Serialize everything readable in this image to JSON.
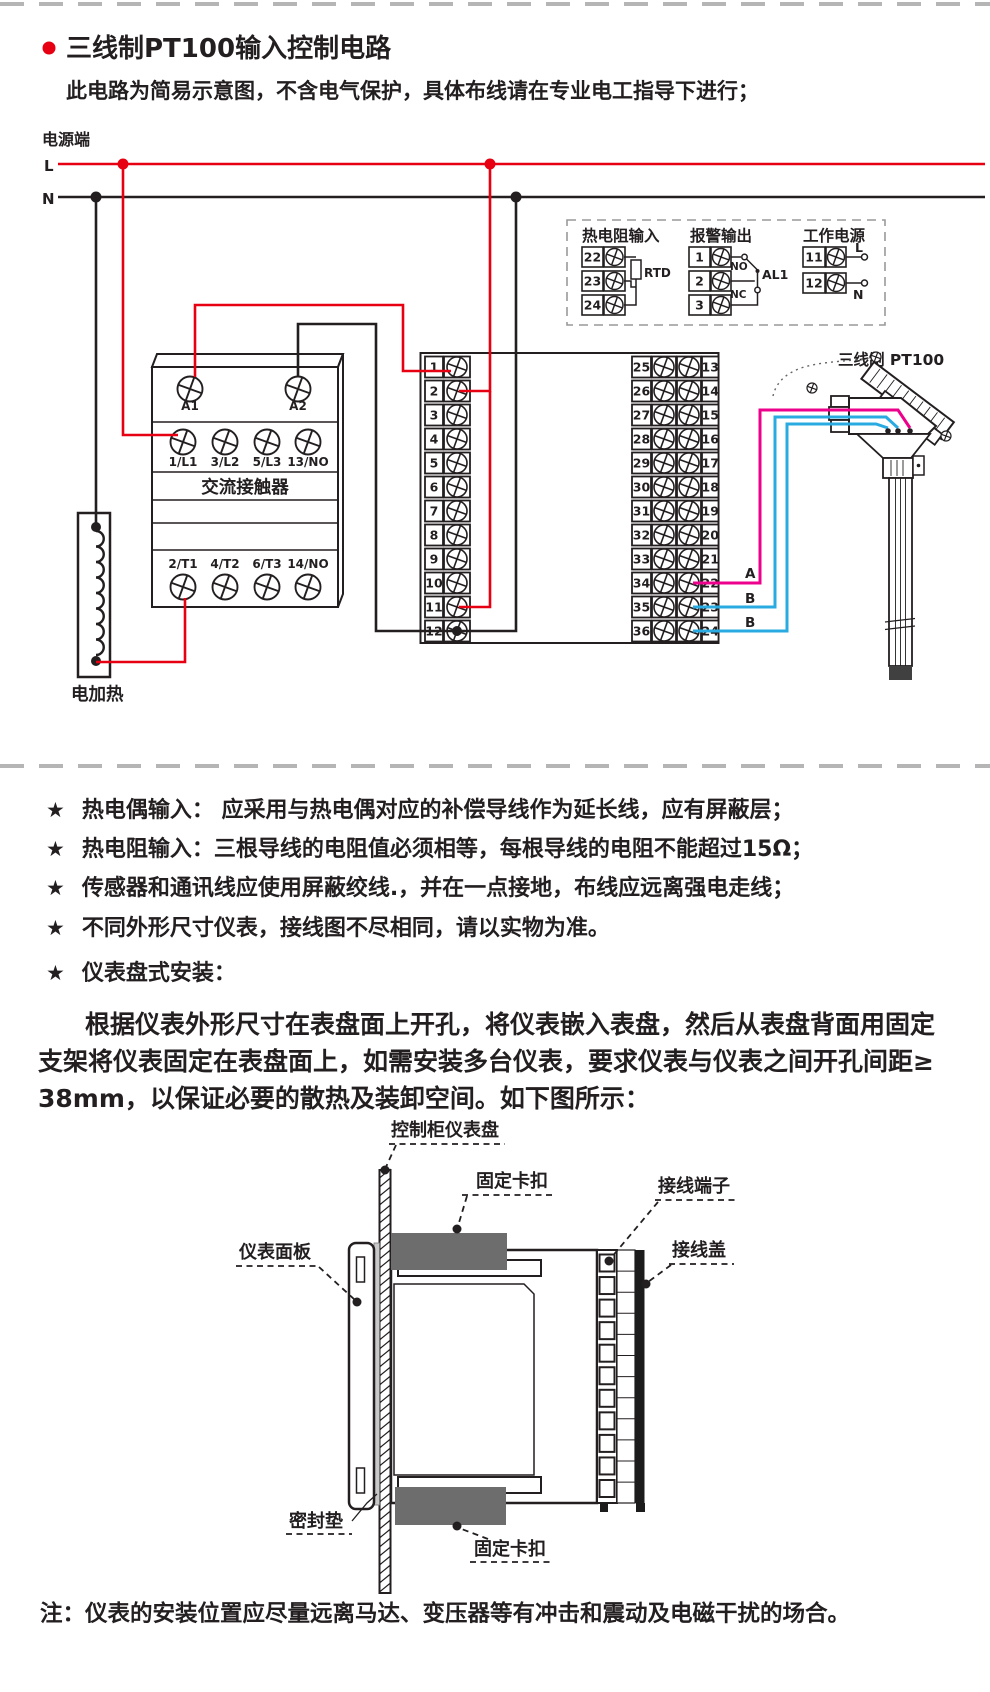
{
  "colors": {
    "red": "#e60012",
    "black": "#231f20",
    "magenta": "#ec008c",
    "blue": "#29abe2",
    "gray_clamp": "#6d6d6d",
    "divider_gray": "#b5b5b5"
  },
  "header": {
    "title": "三线制PT100输入控制电路",
    "subtitle": "此电路为简易示意图，不含电气保护，具体布线请在专业电工指导下进行；"
  },
  "circuit": {
    "power_label": "电源端",
    "line_l": "L",
    "line_n": "N",
    "contactor": {
      "name": "交流接触器",
      "coil_terminals": [
        "A1",
        "A2"
      ],
      "input_terminals": [
        "1/L1",
        "3/L2",
        "5/L3",
        "13/NO"
      ],
      "output_terminals": [
        "2/T1",
        "4/T2",
        "6/T3",
        "14/NO"
      ]
    },
    "heater_label": "电加热",
    "instrument": {
      "left_terminals": [
        "1",
        "2",
        "3",
        "4",
        "5",
        "6",
        "7",
        "8",
        "9",
        "10",
        "11",
        "12"
      ],
      "right_outer_terminals": [
        "25",
        "26",
        "27",
        "28",
        "29",
        "30",
        "31",
        "32",
        "33",
        "34",
        "35",
        "36"
      ],
      "right_inner_terminals": [
        "13",
        "14",
        "15",
        "16",
        "17",
        "18",
        "19",
        "20",
        "21",
        "22",
        "23",
        "24"
      ]
    },
    "legend": {
      "rtd": {
        "title": "热电阻输入",
        "terminals": [
          "22",
          "23",
          "24"
        ],
        "component_label": "RTD"
      },
      "alarm": {
        "title": "报警输出",
        "terminals": [
          "1",
          "2",
          "3"
        ],
        "no_label": "NO",
        "nc_label": "NC",
        "relay_label": "AL1"
      },
      "supply": {
        "title": "工作电源",
        "terminals": [
          "11",
          "12"
        ],
        "l_label": "L",
        "n_label": "N"
      }
    },
    "sensor": {
      "label": "三线制 PT100",
      "wire_a": "A",
      "wire_b1": "B",
      "wire_b2": "B"
    }
  },
  "notes": {
    "bullet_symbol": "★",
    "bullets": [
      "热电偶输入： 应采用与热电偶对应的补偿导线作为延长线，应有屏蔽层；",
      "热电阻输入：三根导线的电阻值必须相等，每根导线的电阻不能超过15Ω；",
      "传感器和通讯线应使用屏蔽绞线.，并在一点接地，布线应远离强电走线；",
      "不同外形尺寸仪表，接线图不尽相同，请以实物为准。",
      "仪表盘式安装："
    ],
    "paragraph_lines": [
      "根据仪表外形尺寸在表盘面上开孔，将仪表嵌入表盘，然后从表盘背面用固定",
      "支架将仪表固定在表盘面上，如需安装多台仪表，要求仪表与仪表之间开孔间距≥",
      "38mm，以保证必要的散热及装卸空间。如下图所示："
    ]
  },
  "mount": {
    "labels": {
      "panel": "控制柜仪表盘",
      "clip_top": "固定卡扣",
      "terminals": "接线端子",
      "cover": "接线盖",
      "faceplate": "仪表面板",
      "gasket": "密封垫",
      "clip_bottom": "固定卡扣"
    }
  },
  "footer": {
    "note": "注：仪表的安装位置应尽量远离马达、变压器等有冲击和震动及电磁干扰的场合。"
  }
}
